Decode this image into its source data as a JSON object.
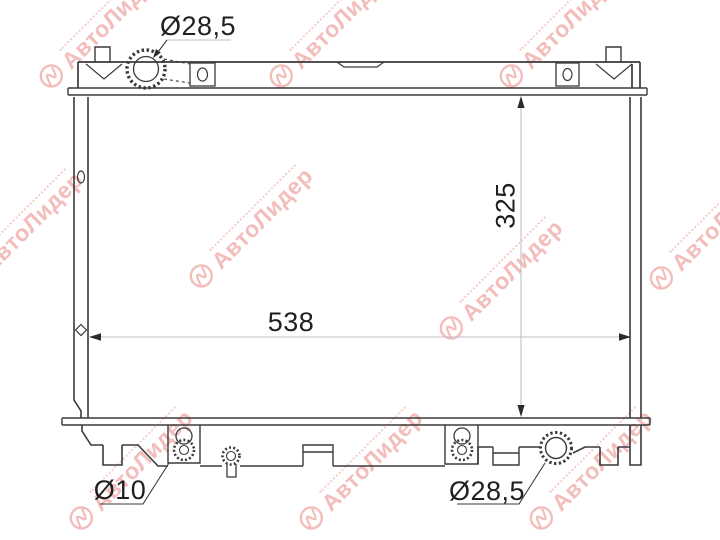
{
  "page": {
    "background_color": "#ffffff"
  },
  "watermark": {
    "brand": "АвтоЛидер",
    "color_hex": "#df5a54",
    "opacity": 0.4
  },
  "diagram": {
    "line_color_hex": "#3a3a3a",
    "dim_line_color_hex": "#c0c0c8",
    "dimensions": {
      "filler_neck_diameter": {
        "label": "Ø28,5"
      },
      "core_width": {
        "label": "538"
      },
      "core_height": {
        "label": "325"
      },
      "drain_plug_diameter": {
        "label": "Ø10"
      },
      "outlet_diameter": {
        "label": "Ø28,5"
      }
    }
  }
}
